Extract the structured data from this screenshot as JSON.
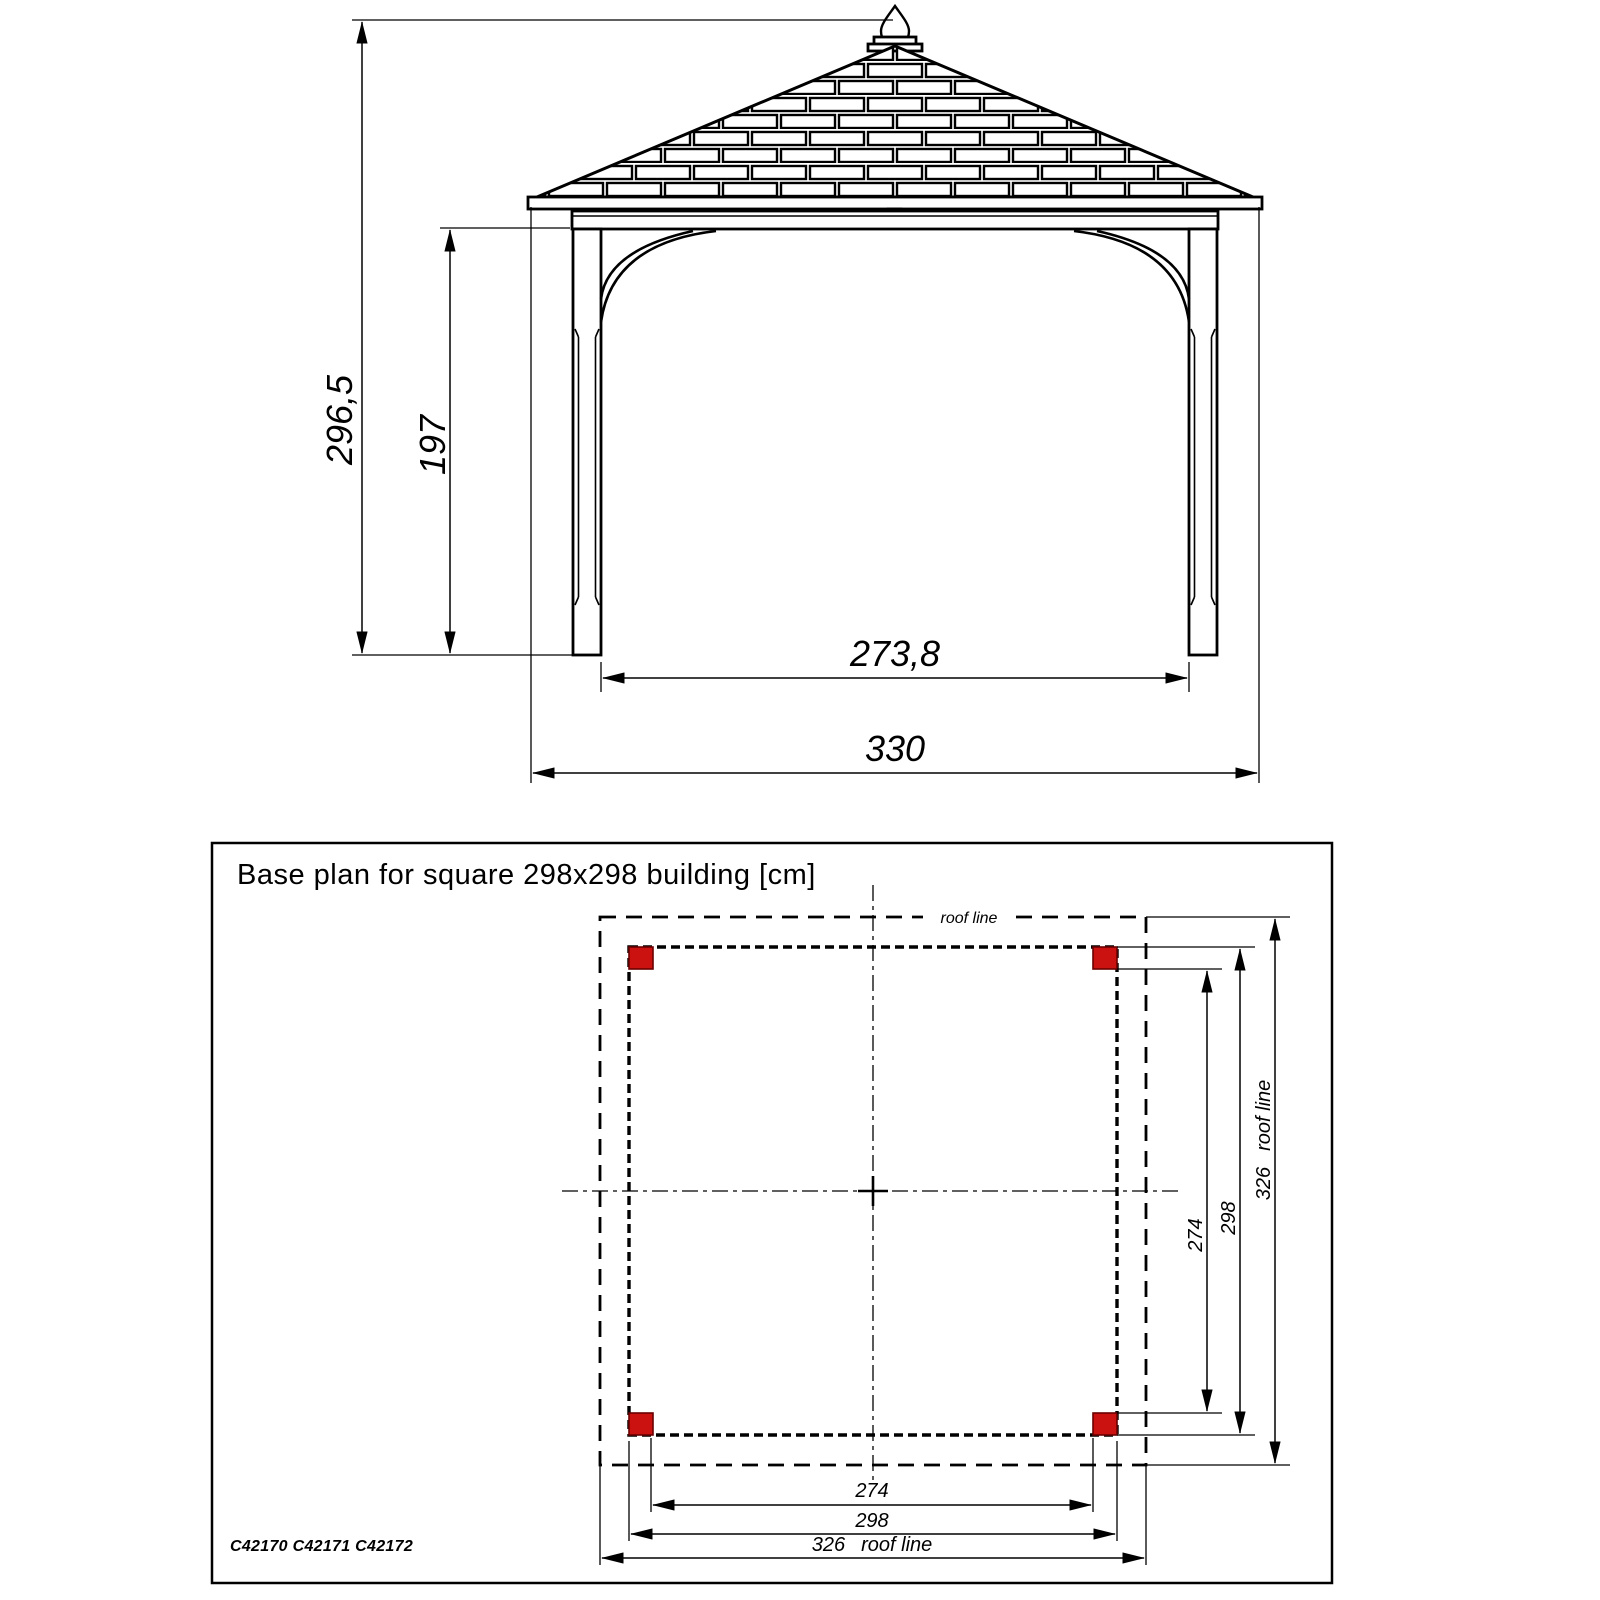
{
  "elevation": {
    "dims": {
      "total_height": "296,5",
      "post_clear_height": "197",
      "inner_width": "273,8",
      "overall_width": "330"
    }
  },
  "plan": {
    "title": "Base plan for square 298x298 building [cm]",
    "roof_line_label": "roof line",
    "dims": {
      "right": {
        "inner": "274",
        "building": "298",
        "roof_value": "326",
        "roof_label": "roof line"
      },
      "bottom": {
        "inner": "274",
        "building": "298",
        "roof_value": "326",
        "roof_label": "roof line"
      }
    },
    "product_codes": "C42170 C42171 C42172",
    "post_color": "#cc1111",
    "post_border_color": "#6b0000"
  }
}
